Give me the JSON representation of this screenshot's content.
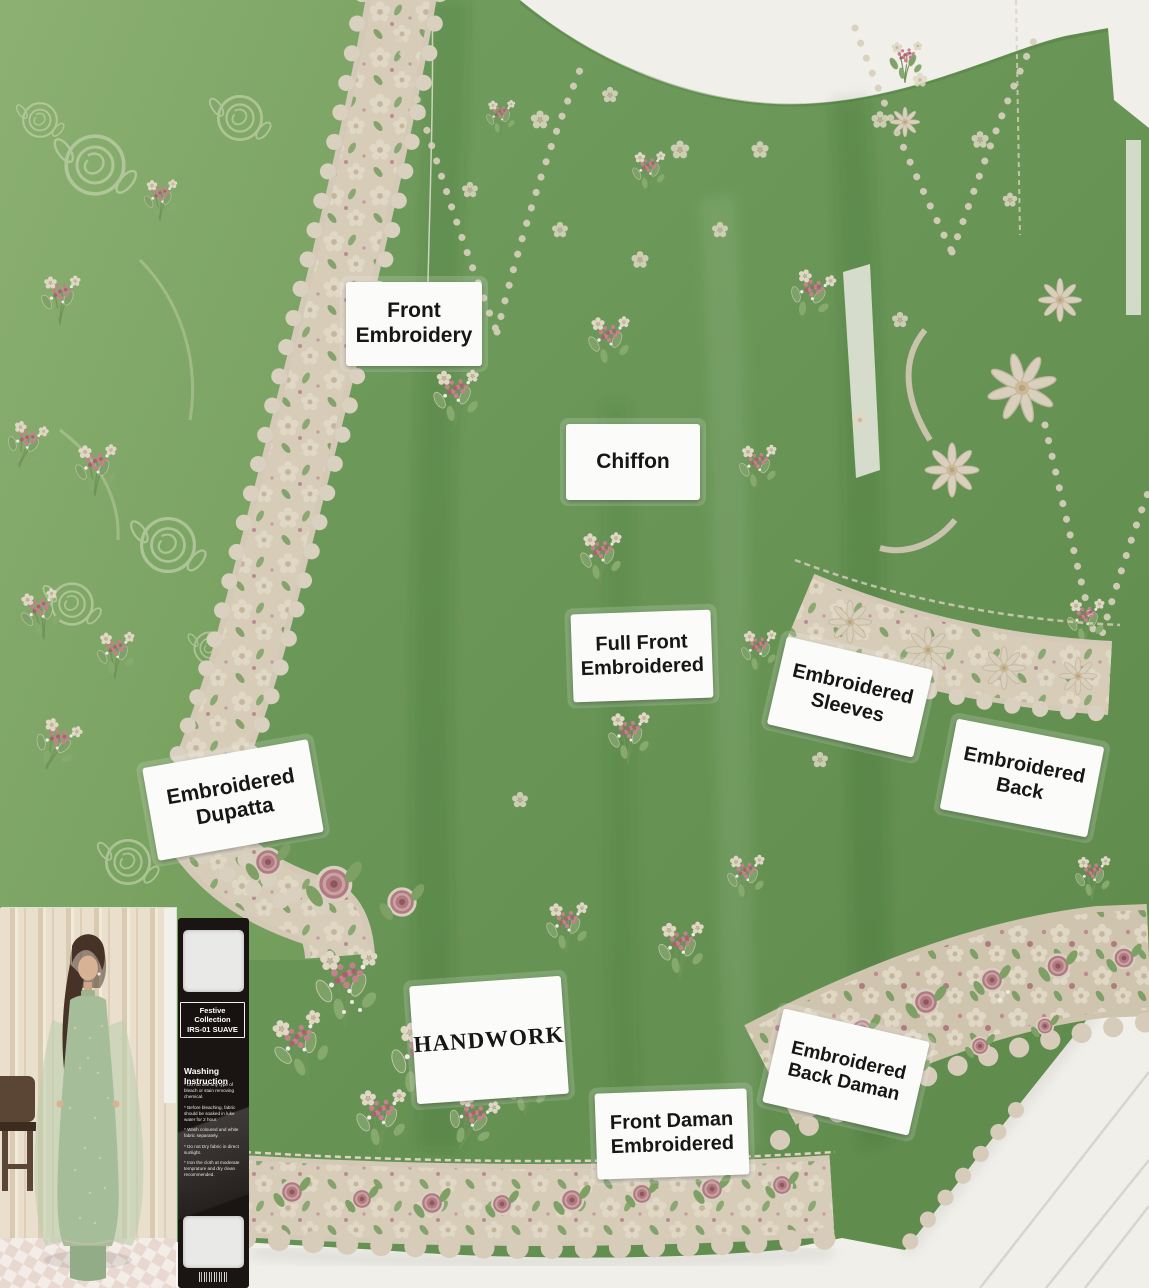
{
  "labels": [
    {
      "id": "front-embroidery",
      "text": "Front\nEmbroidery"
    },
    {
      "id": "chiffon",
      "text": "Chiffon"
    },
    {
      "id": "full-front-embroidered",
      "text": "Full Front\nEmbroidered"
    },
    {
      "id": "embroidered-sleeves",
      "text": "Embroidered\nSleeves"
    },
    {
      "id": "embroidered-back",
      "text": "Embroidered\nBack"
    },
    {
      "id": "embroidered-dupatta",
      "text": "Embroidered\nDupatta"
    },
    {
      "id": "handwork",
      "text": "HANDWORK"
    },
    {
      "id": "embroidered-back-daman",
      "text": "Embroidered\nBack Daman"
    },
    {
      "id": "front-daman-embroidered",
      "text": "Front Daman\nEmbroidered"
    }
  ],
  "tag": {
    "collection_line": "Festive Collection\nIRS-01 SUAVE",
    "washing_title": "Washing Instruction",
    "washing_items": [
      "* Do not use any type of bleach or stain removing chemical.",
      "* Before bleaching, fabric should be soaked in luke water for 2 hour.",
      "* Wash coloured and white fabric separately.",
      "* Do not Dry fabric in direct sunlight.",
      "* Iron the cloth at moderate temprature and dry clean recommended."
    ],
    "barcode_icon": "barcode-icon"
  },
  "colors": {
    "fabric_green": "#6d9759",
    "dupatta_green": "#86aa6d",
    "embroidery_cream": "#d6ccb8",
    "embroidery_pink": "#bb7f88",
    "label_bg": "#fbfbf9",
    "label_text": "#161616",
    "tag_bg": "#1a1512",
    "wall_white": "#f0efea"
  }
}
